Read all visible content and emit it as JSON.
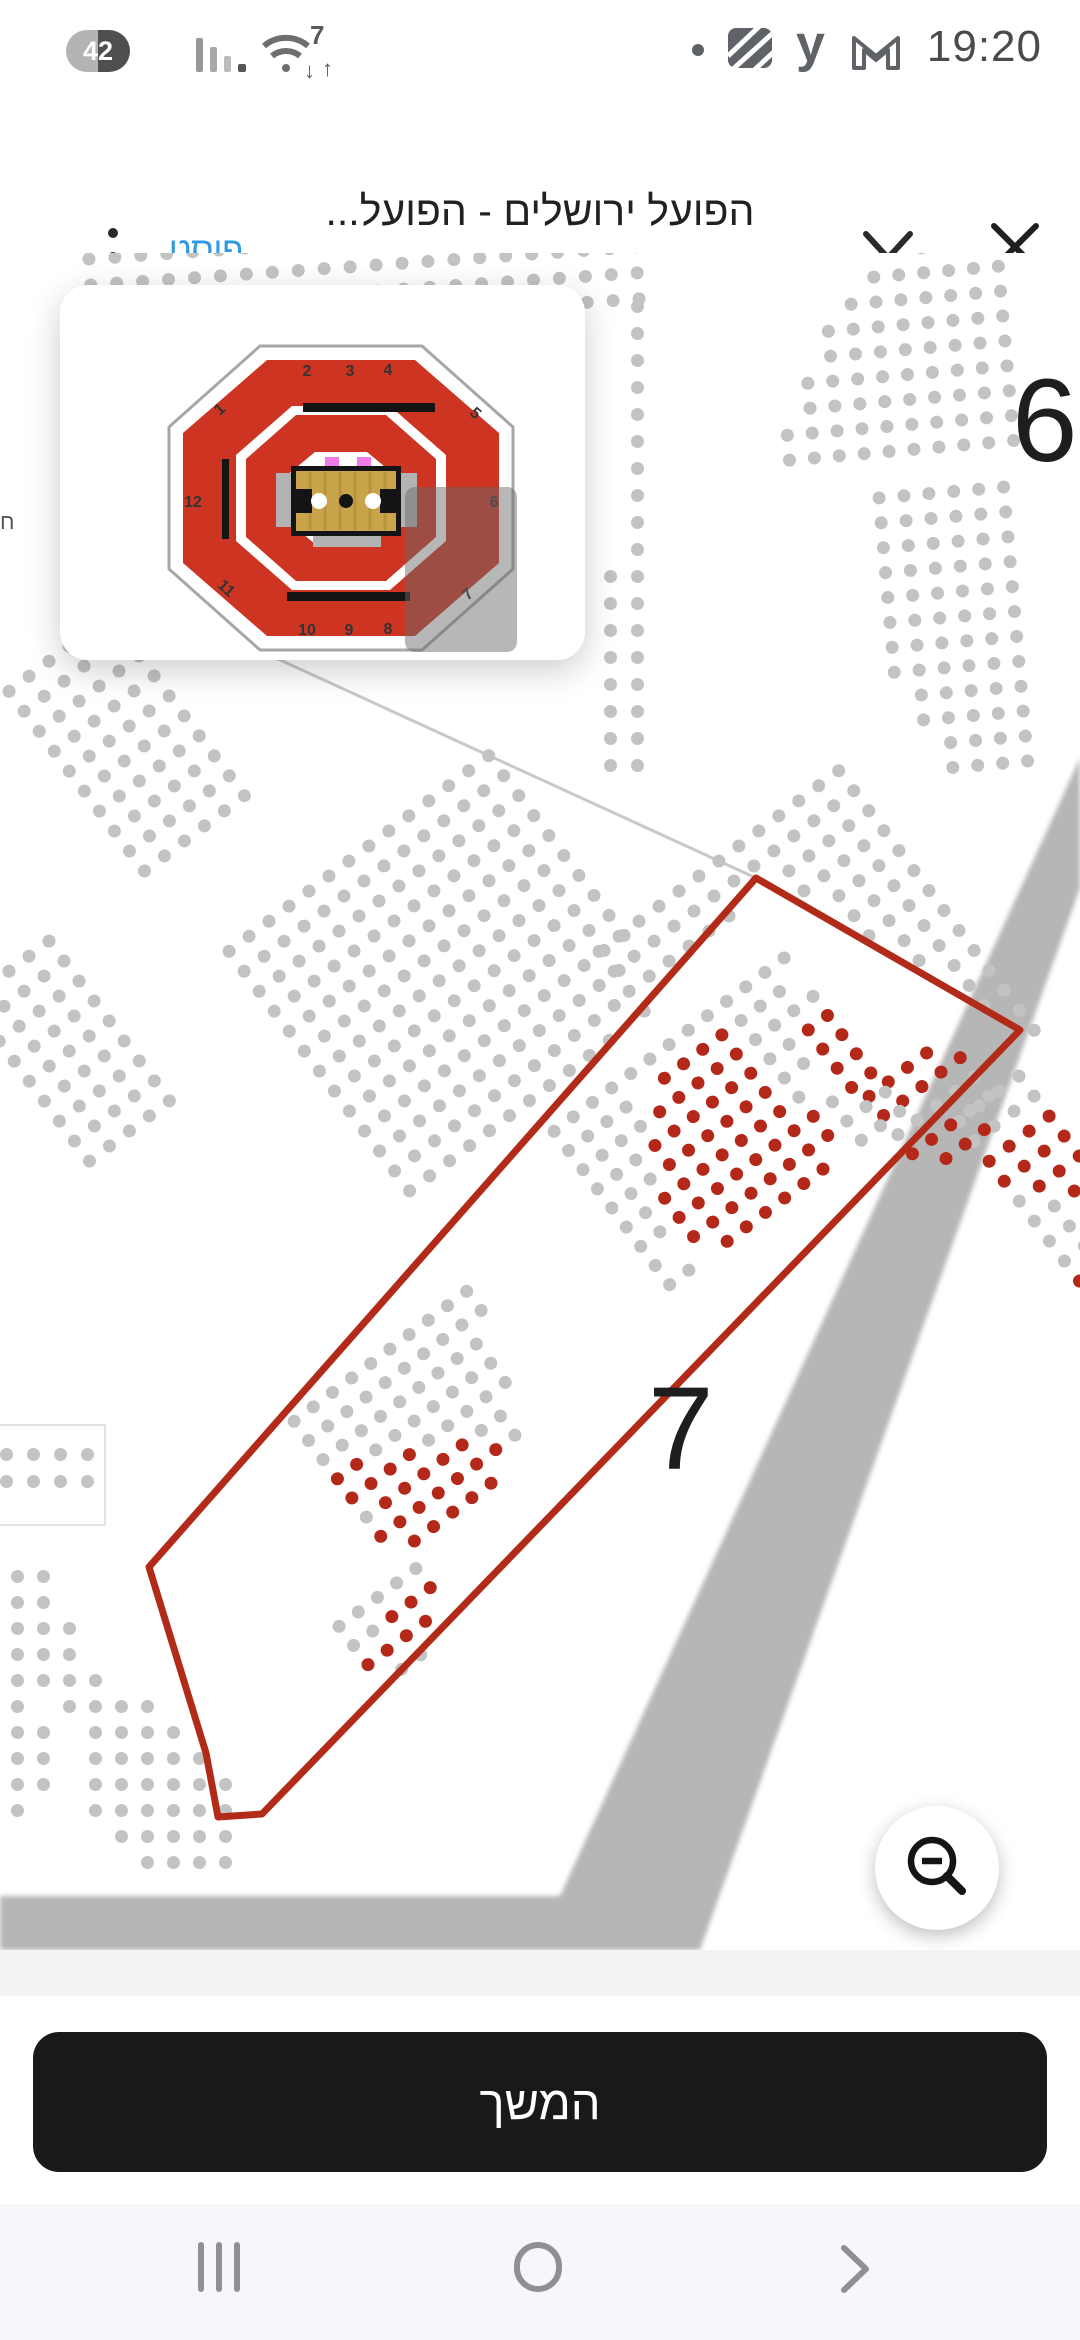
{
  "status_bar": {
    "battery_level": "42",
    "time": "19:20",
    "wifi_gen": "7",
    "right_glyphs": {
      "yahoo": "y"
    }
  },
  "browser_header": {
    "action_label": "פוסט",
    "page_title": "הפועל ירושלים - הפועל...",
    "page_url": "tickets.hapoelbc.com"
  },
  "seat_map": {
    "colors": {
      "seat_gray": "#c3c3c3",
      "seat_red": "#b4281a",
      "outline_red": "#b22a18",
      "walkway_band": "#b6b6b6",
      "tier_line": "#c9c9c9"
    },
    "section_labels": [
      {
        "text": "6",
        "x": 1012,
        "y": 100,
        "size": 118
      },
      {
        "text": "7",
        "x": 648,
        "y": 1108,
        "size": 118
      }
    ],
    "edge_label": {
      "text": "ח",
      "x": 0,
      "y": 256
    },
    "section7_outline": {
      "points": "756,625 1020,777 262,1561 218,1564 206,1500 149,1314"
    },
    "tier_line": {
      "x1": 230,
      "y1": 384,
      "x2": 756,
      "y2": 625
    },
    "walkway_band_points": "1080,505 1080,635 700,1697 0,1697 0,1643 560,1643",
    "white_box": {
      "x": -25,
      "y": 1172,
      "w": 130,
      "h": 100
    },
    "seat_blocks": [
      {
        "name": "upper-left-strip",
        "x": 82,
        "y": 0,
        "rot": -4,
        "sp": 26,
        "rows": [
          "gggggggggggggggggggggg",
          "gggggggggggggggggggggg",
          "gggggggggggggggggggggg",
          "gggggggggggggggggggggg"
        ]
      },
      {
        "name": "beside-minimap-strip",
        "x": 604,
        "y": 47,
        "rot": 0,
        "sp": 27,
        "rows": [
          ".g",
          ".g",
          ".g",
          ".g",
          ".g",
          ".g",
          ".g",
          ".g",
          ".g",
          ".g",
          "gg",
          "gg",
          "gg",
          "gg",
          "gg",
          "gg",
          "gg",
          "gg"
        ]
      },
      {
        "name": "section6-upper",
        "x": 765,
        "y": 2,
        "rot": -5,
        "sp": 25,
        "rows": [
          "......gggg",
          "....gggggg",
          "...ggggggg",
          "..gggggggg",
          "..gggggggg",
          ".ggggggggg",
          ".ggggggggg",
          "gggggggggg",
          "gggggggggg"
        ]
      },
      {
        "name": "section6-lower",
        "x": 872,
        "y": 239,
        "rot": -5,
        "sp": 25,
        "rows": [
          "gggggg",
          "gggggg",
          "gggggg",
          "gggggg",
          "gggggg",
          "gggggg",
          "gggggg",
          "gggggg",
          ".ggggg",
          ".ggggg",
          "..gggg",
          "..gggg"
        ]
      },
      {
        "name": "left-tier-a",
        "x": 0,
        "y": 437,
        "rot": -37,
        "sp": 25,
        "rows": [
          "gggggg",
          "gggggg",
          "gggggg",
          "gggggg",
          "gggggg",
          "gggggg",
          "gggggg",
          "gggggg",
          "gggggg",
          "gggggg"
        ]
      },
      {
        "name": "left-tier-b",
        "x": -40,
        "y": 747,
        "rot": -37,
        "sp": 25,
        "rows": [
          "ggggg",
          "ggggg",
          "ggggg",
          "ggggg",
          "ggggg",
          "ggggg",
          "ggggg",
          "ggggg",
          "ggggg"
        ]
      },
      {
        "name": "mid-tier",
        "x": 220,
        "y": 697,
        "rot": -37,
        "sp": 25,
        "rows": [
          "gggggggggggggg",
          "gggggggggggggg",
          "gggggggggggggg",
          "gggggggggggggg",
          "gggggggggggggg",
          "gggggggggggggg",
          "gggggggggggggg",
          "gggggggggggggg",
          "gggggggggggggg",
          "gggggggggggggg",
          "ggggggggggggg.",
          "gggggggggggg..",
          "ggggggggggg..."
        ]
      },
      {
        "name": "right-tier",
        "x": 590,
        "y": 697,
        "rot": -37,
        "sp": 25,
        "rows": [
          "ggggggggggggg",
          "ggggggggggggg",
          "gggggg..ggggg",
          "g.......ggggg",
          ".........gggg",
          ".........gggg",
          ".........gggg",
          "..........ggg",
          "..........ggg",
          "...........gg",
          "...........gg",
          "...........gg",
          "............g",
          "............g"
        ]
      },
      {
        "name": "corner-box-seats",
        "x": 0,
        "y": 1195,
        "rot": 0,
        "sp": 27,
        "rows": [
          "gggg",
          "gggg"
        ]
      },
      {
        "name": "bottom-left-seats",
        "x": -15,
        "y": 1317,
        "rot": 0,
        "sp": 26,
        "rows": [
          "ggg.......",
          "ggg.......",
          "gggg......",
          "gggg......",
          "ggggg.....",
          "gg.gggg...",
          "ggg.gggg..",
          "ggg.ggggg.",
          "ggg.gggggg",
          "gg..gggggg",
          "g....ggggg",
          "......gggg"
        ]
      },
      {
        "name": "right-edge-seats",
        "x": 950,
        "y": 867,
        "rot": -37,
        "sp": 25,
        "rows": [
          "gggg",
          "gggg",
          "rrrr",
          "rrrr",
          "grrr",
          "ggrr",
          "gggg",
          "gggg",
          "rrgg",
          "rrrg"
        ]
      },
      {
        "name": "s7-top-block",
        "x": 860,
        "y": 842,
        "rot": -37,
        "sp": 24,
        "rows": [
          "rrrr.",
          "rrrrr",
          "ggggg",
          "rrrgg",
          ".rrr."
        ]
      },
      {
        "name": "s7-main-block",
        "x": 545,
        "y": 877,
        "rot": -37,
        "sp": 24,
        "rows": [
          "ggggggggggggg",
          "gggg.rrrrggg.",
          "ggggrrrrrgggg",
          "gggrrrrrrggrr",
          "gggrrrrrrggrr",
          "ggrrrrrrrg.rr",
          "ggrrrrrrrrgrr",
          "g.rrrrrrrrggg",
          "gg.rrrrrr.ggg"
        ]
      },
      {
        "name": "s7-lower-block",
        "x": 285,
        "y": 1167,
        "rot": -37,
        "sp": 24,
        "rows": [
          "gggggggggg",
          "gggggggggg",
          "ggggggggg.",
          "rrggggggg.",
          "rrrrggggg.",
          "grrrrrgg..",
          "rrrrrrrg..",
          ".rrrrr...."
        ]
      },
      {
        "name": "s7-tip-block",
        "x": 330,
        "y": 1372,
        "rot": -37,
        "sp": 24,
        "rows": [
          "ggggg",
          "ggrrr",
          "rrrr.",
          ".gg.."
        ]
      }
    ]
  },
  "minimap": {
    "colors": {
      "ring_red": "#cd3522",
      "boundary": "#a7a7a7",
      "court_wood": "#c9a44a",
      "court_stripe": "#b8933d",
      "platform": "#b3b3b3",
      "bar_black": "#141414",
      "pink_mark": "#f07ce8",
      "number": "#333333"
    },
    "section_numbers": [
      {
        "n": "1",
        "x": 163,
        "y": 128,
        "rot": -42
      },
      {
        "n": "2",
        "x": 247,
        "y": 91,
        "rot": 0
      },
      {
        "n": "3",
        "x": 290,
        "y": 91,
        "rot": 0
      },
      {
        "n": "4",
        "x": 328,
        "y": 90,
        "rot": 0
      },
      {
        "n": "5",
        "x": 412,
        "y": 132,
        "rot": 42
      },
      {
        "n": "6",
        "x": 434,
        "y": 222,
        "rot": 0
      },
      {
        "n": "7",
        "x": 411,
        "y": 313,
        "rot": -42
      },
      {
        "n": "8",
        "x": 328,
        "y": 349,
        "rot": 0
      },
      {
        "n": "9",
        "x": 289,
        "y": 350,
        "rot": 0
      },
      {
        "n": "10",
        "x": 247,
        "y": 350,
        "rot": 0
      },
      {
        "n": "11",
        "x": 163,
        "y": 307,
        "rot": 42
      },
      {
        "n": "12",
        "x": 133,
        "y": 222,
        "rot": 0
      }
    ],
    "viewport": {
      "x": 345,
      "y": 202,
      "w": 112,
      "h": 165
    }
  },
  "footer": {
    "continue_label": "המשך"
  }
}
